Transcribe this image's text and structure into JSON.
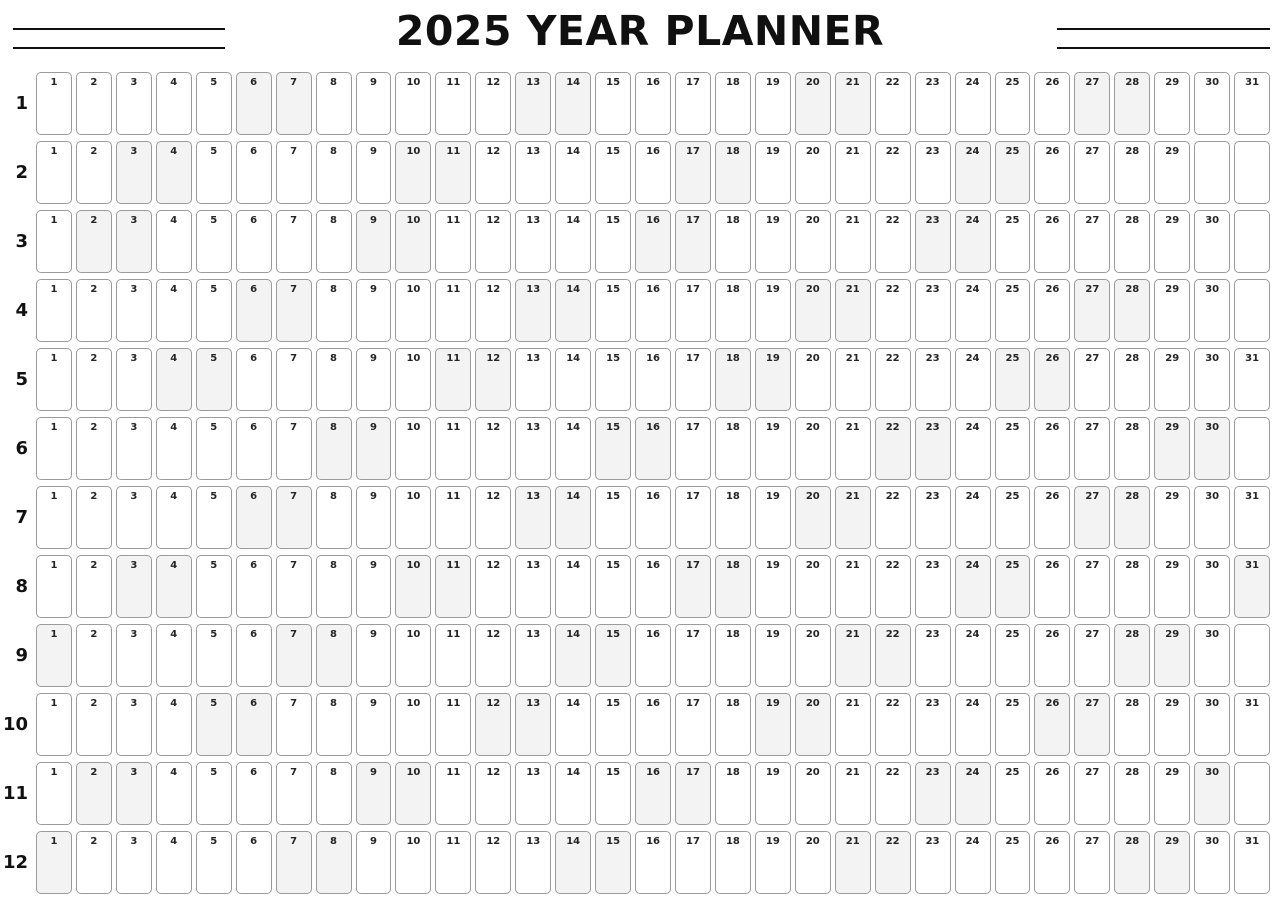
{
  "header": {
    "title": "2025 YEAR PLANNER"
  },
  "colors": {
    "title_text": "#101010",
    "rule_line": "#101010",
    "cell_border": "#9b9b9b",
    "cell_background": "#ffffff",
    "shaded_cell_background": "#f3f3f3",
    "day_number_text": "#252525"
  },
  "grid": {
    "total_slots_per_row": 31,
    "day_numbering_starts_at": 1,
    "months": [
      {
        "month_number": "1",
        "day_end": 31,
        "trailing_blank_cells": 0,
        "shaded_days": [
          6,
          7,
          13,
          14,
          20,
          21,
          27,
          28
        ]
      },
      {
        "month_number": "2",
        "day_end": 29,
        "trailing_blank_cells": 2,
        "shaded_days": [
          3,
          4,
          10,
          11,
          17,
          18,
          24,
          25
        ]
      },
      {
        "month_number": "3",
        "day_end": 30,
        "trailing_blank_cells": 1,
        "shaded_days": [
          2,
          3,
          9,
          10,
          16,
          17,
          23,
          24
        ]
      },
      {
        "month_number": "4",
        "day_end": 30,
        "trailing_blank_cells": 1,
        "shaded_days": [
          6,
          7,
          13,
          14,
          20,
          21,
          27,
          28
        ]
      },
      {
        "month_number": "5",
        "day_end": 31,
        "trailing_blank_cells": 0,
        "shaded_days": [
          4,
          5,
          11,
          12,
          18,
          19,
          25,
          26
        ]
      },
      {
        "month_number": "6",
        "day_end": 30,
        "trailing_blank_cells": 1,
        "shaded_days": [
          8,
          9,
          15,
          16,
          22,
          23,
          29,
          30
        ]
      },
      {
        "month_number": "7",
        "day_end": 31,
        "trailing_blank_cells": 0,
        "shaded_days": [
          6,
          7,
          13,
          14,
          20,
          21,
          27,
          28
        ]
      },
      {
        "month_number": "8",
        "day_end": 31,
        "trailing_blank_cells": 0,
        "shaded_days": [
          3,
          4,
          10,
          11,
          17,
          18,
          24,
          25,
          31
        ]
      },
      {
        "month_number": "9",
        "day_end": 30,
        "trailing_blank_cells": 1,
        "shaded_days": [
          1,
          7,
          8,
          14,
          15,
          21,
          22,
          28,
          29
        ]
      },
      {
        "month_number": "10",
        "day_end": 31,
        "trailing_blank_cells": 0,
        "shaded_days": [
          5,
          6,
          12,
          13,
          19,
          20,
          26,
          27
        ]
      },
      {
        "month_number": "11",
        "day_end": 30,
        "trailing_blank_cells": 1,
        "shaded_days": [
          2,
          3,
          9,
          10,
          16,
          17,
          23,
          24,
          30
        ]
      },
      {
        "month_number": "12",
        "day_end": 31,
        "trailing_blank_cells": 0,
        "shaded_days": [
          1,
          7,
          8,
          14,
          15,
          21,
          22,
          28,
          29
        ]
      }
    ]
  }
}
